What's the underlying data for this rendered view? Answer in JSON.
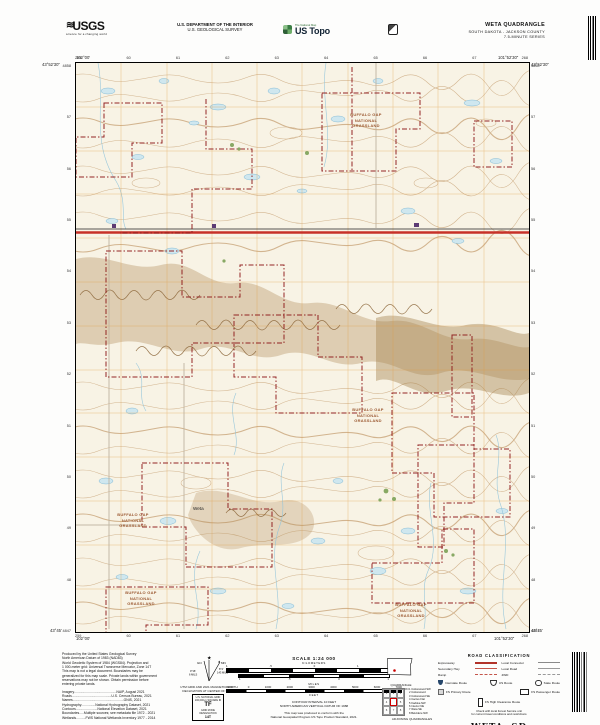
{
  "header": {
    "usgs_logo": "USGS",
    "usgs_tagline": "science for a changing world",
    "dept_line1": "U.S. DEPARTMENT OF THE INTERIOR",
    "dept_line2": "U.S. GEOLOGICAL SURVEY",
    "national_map": "The National Map",
    "ustopo": "US Topo",
    "quad_name": "WETA QUADRANGLE",
    "quad_state_county": "SOUTH DAKOTA - JACKSON COUNTY",
    "quad_series": "7.5-MINUTE SERIES"
  },
  "map": {
    "corner_labels": {
      "top_left_lon": "102°00'",
      "top_left_lat": "43°52'30\"",
      "top_right_lon": "101°52'30\"",
      "top_right_lat": "43°52'30\"",
      "bottom_left_lon": "102°00'",
      "bottom_left_lat": "43°45'",
      "bottom_right_lon": "101°52'30\"",
      "bottom_right_lat": "43°45'"
    },
    "top_grid_ticks": [
      "259",
      "60",
      "61",
      "62",
      "63",
      "64",
      "65",
      "66",
      "67",
      "268"
    ],
    "bottom_grid_ticks": [
      "259",
      "60",
      "61",
      "62",
      "63",
      "64",
      "65",
      "66",
      "67",
      "268"
    ],
    "left_grid_ticks": [
      "4858",
      "57",
      "56",
      "55",
      "54",
      "53",
      "52",
      "51",
      "50",
      "49",
      "48",
      "4847"
    ],
    "right_grid_ticks": [
      "4858",
      "57",
      "56",
      "55",
      "54",
      "53",
      "52",
      "51",
      "50",
      "49",
      "48",
      "4847"
    ],
    "grassland_label": {
      "line1": "BUFFALO GAP",
      "line2": "NATIONAL",
      "line3": "GRASSLAND"
    },
    "town_label": "Weta"
  },
  "footer": {
    "produced_lines": [
      "Produced by the United States Geological Survey",
      "North American Datum of 1983 (NAD83)",
      "World Geodetic System of 1984 (WGS84). Projection and",
      "1 000-meter grid: Universal Transverse Mercator, Zone 14T",
      "This map is not a legal document. Boundaries may be",
      "generalized for this map scale. Private lands within government",
      "reservations may not be shown. Obtain permission before",
      "entering private lands."
    ],
    "credit_lines": [
      "Imagery.............................................NAIP, August 2021",
      "Roads..........................................U.S. Census Bureau, 2021",
      "Names......................................................GNIS, 2021",
      "Hydrography...............National Hydrography Dataset, 2021",
      "Contours.......................National Elevation Dataset, 2021",
      "Boundaries.....Multiple sources; see metadata file 1972 - 2021",
      "Wetlands..........FWS National Wetlands Inventory 1977 - 2014"
    ],
    "declination": {
      "gn": "GN",
      "mn": "MN",
      "gn_value": "0°16'",
      "gn_mils": "6 MILS",
      "mn_value": "8°4'",
      "mn_mils": "143 MILS",
      "caption1": "UTM GRID AND 2021 MAGNETIC NORTH",
      "caption2": "DECLINATION AT CENTER OF SHEET"
    },
    "usng": {
      "title": "U.S. NATIONAL GRID",
      "sub": "100,000-m SQUARE ID",
      "square_id": "TF",
      "zone_label": "GRID ZONE DESIGNATION",
      "zone": "14T"
    },
    "scale": {
      "title": "SCALE 1:24 000",
      "km_label": "KILOMETERS",
      "km_ticks": [
        "1",
        ".5",
        "0",
        "1",
        "2"
      ],
      "miles_label": "MILES",
      "miles_ticks": [
        "1",
        ".5",
        "0",
        "1"
      ],
      "feet_label": "FEET",
      "feet_ticks": [
        "1000",
        "0",
        "1000",
        "2000",
        "3000",
        "4000",
        "5000",
        "6000",
        "7000"
      ],
      "contour_note": "CONTOUR INTERVAL 10 FEET",
      "datum_note": "NORTH AMERICAN VERTICAL DATUM OF 1988",
      "standard_note1": "This map was produced to conform with the",
      "standard_note2": "National Geospatial Program US Topo Product Standard, 2021."
    },
    "location_caption": "QUADRANGLE LOCATION",
    "adjoining": {
      "caption": "ADJOINING QUADRANGLES",
      "cells": [
        "1",
        "2",
        "3",
        "4",
        "",
        "5",
        "6",
        "7",
        "8"
      ],
      "names": [
        "1 Cottonwood SW",
        "2 Cottonwood",
        "3 Cottonwood SE",
        "4 Cactus Flat",
        "5 Kadoka NW",
        "6 Interior NE",
        "7 Weta SE",
        "8 Belvidere NW"
      ]
    },
    "road_class": {
      "title": "ROAD CLASSIFICATION",
      "rows": [
        {
          "label": "Expressway"
        },
        {
          "label": "Local Connector"
        },
        {
          "label": "Secondary Hwy"
        },
        {
          "label": "Local Road"
        },
        {
          "label": "Ramp"
        },
        {
          "label": "4WD"
        }
      ],
      "shields": [
        {
          "label": "Interstate Route"
        },
        {
          "label": "US Route"
        },
        {
          "label": "State Route"
        }
      ],
      "fs": [
        {
          "label": "FS Primary Route"
        },
        {
          "label": "FS Passenger Route"
        },
        {
          "label": "FS High Clearance Route"
        }
      ],
      "note1": "Check with local Forest Service unit",
      "note2": "for current travel conditions and restrictions"
    },
    "title_block": {
      "name": "WETA, SD",
      "year": "2021"
    }
  },
  "colors": {
    "map_background": "#f8f3e5",
    "contour_brown": "#c9a57a",
    "badlands_brown": "#b2905e",
    "water_fill": "#cfe7ef",
    "water_line": "#85bcd6",
    "utm_grid_orange": "#e09a40",
    "boundary_maroon": "#8e1b1b",
    "expressway_red": "#c73128",
    "grassland_label_brown": "#9c5a33",
    "interstate_shield_blue": "#26476b"
  }
}
